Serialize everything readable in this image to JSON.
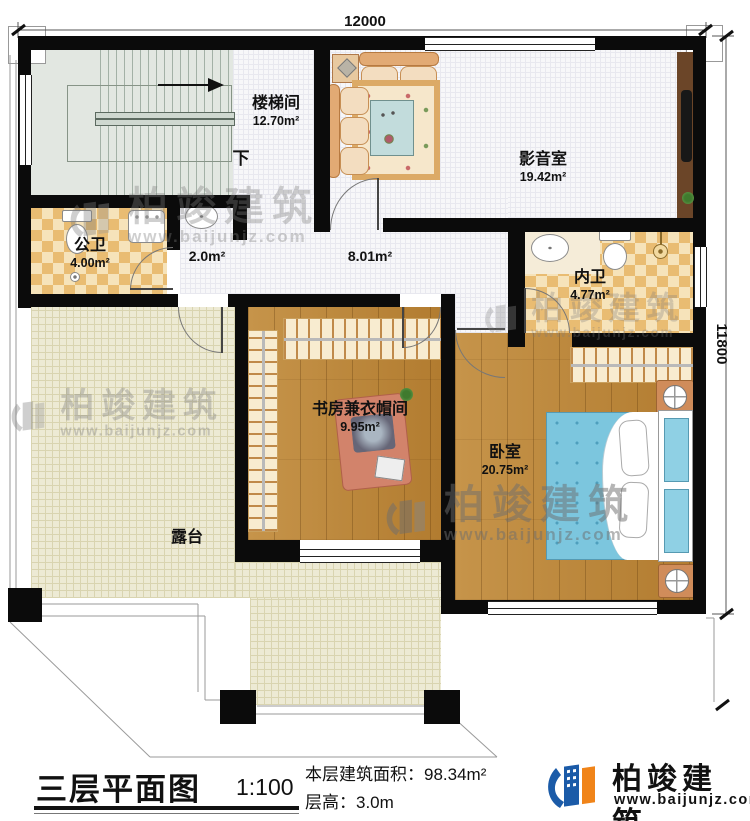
{
  "dimensions": {
    "top": "12000",
    "right": "11800"
  },
  "rooms": [
    {
      "name": "楼梯间",
      "area": "12.70m²"
    },
    {
      "name": "影音室",
      "area": "19.42m²"
    },
    {
      "name": "公卫",
      "area": "4.00m²"
    },
    {
      "name": "",
      "area": "2.0m²"
    },
    {
      "name": "",
      "area": "8.01m²"
    },
    {
      "name": "内卫",
      "area": "4.77m²"
    },
    {
      "name": "书房兼衣帽间",
      "area": "9.95m²"
    },
    {
      "name": "卧室",
      "area": "20.75m²"
    },
    {
      "name": "露台",
      "area": ""
    }
  ],
  "annotations": {
    "stair_direction": "下"
  },
  "title_block": {
    "title": "三层平面图",
    "scale": "1:100",
    "floor_area": "本层建筑面积：98.34m²",
    "floor_height": "层高：3.0m"
  },
  "brand": {
    "name": "柏竣建筑",
    "website": "www.baijunjz.com"
  },
  "watermark": {
    "name": "柏竣建筑",
    "website": "www.baijunjz.com"
  },
  "colors": {
    "wall": "#0b0b0b",
    "wood_floor": "#bd8838",
    "terrace_floor": "#edead4",
    "tile_dark": "#e9bc72",
    "tile_light": "#f6e3ba",
    "stair_floor": "#e2e7e1",
    "bed_blue": "#7cc6de",
    "brand_blue": "#1b5ba8",
    "brand_orange": "#f08419"
  }
}
